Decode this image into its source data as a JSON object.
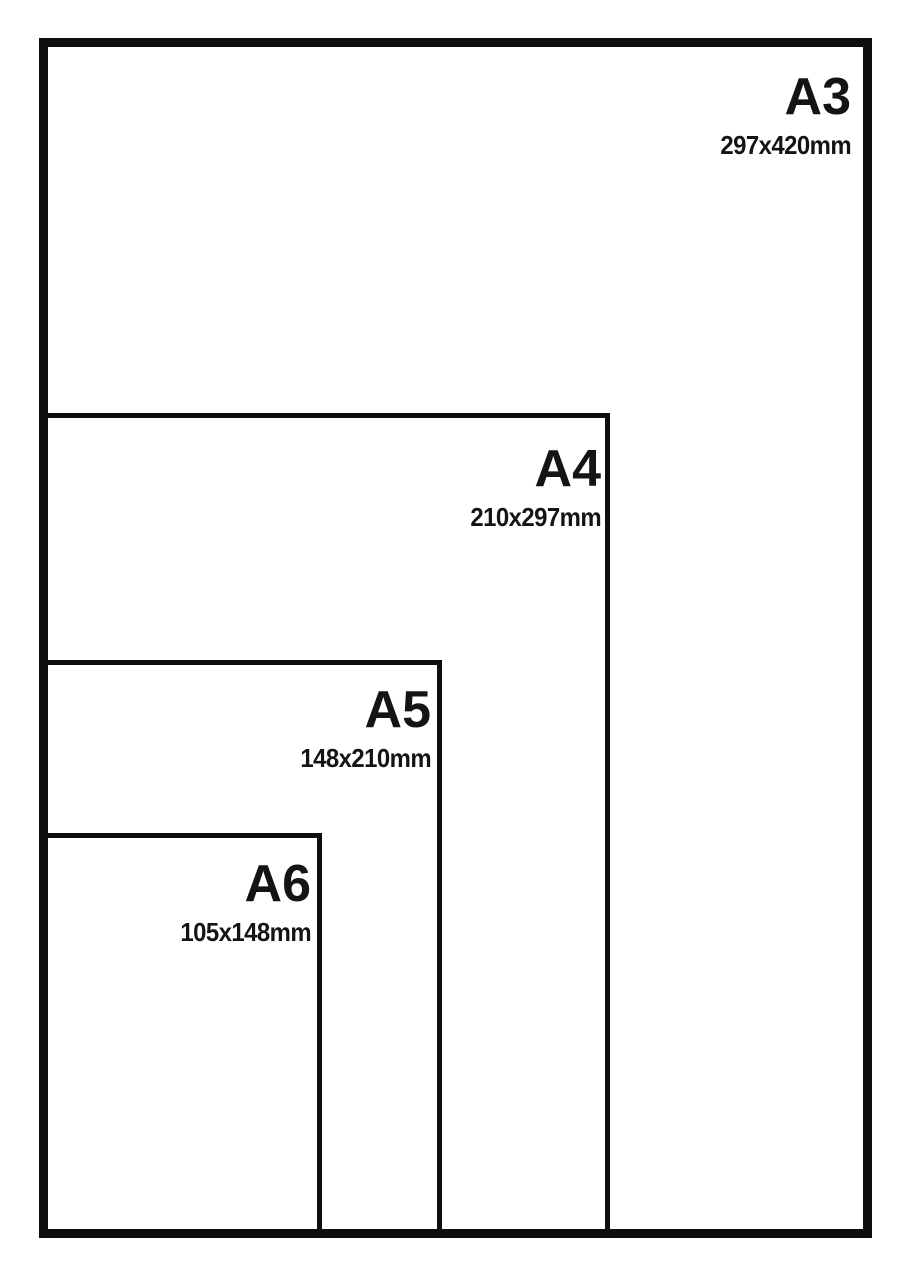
{
  "diagram": {
    "type": "paper-size-comparison",
    "sizes": [
      {
        "name": "A3",
        "dimensions": "297x420mm"
      },
      {
        "name": "A4",
        "dimensions": "210x297mm"
      },
      {
        "name": "A5",
        "dimensions": "148x210mm"
      },
      {
        "name": "A6",
        "dimensions": "105x148mm"
      }
    ]
  },
  "colors": {
    "line": "#0e0e0e",
    "text": "#141414",
    "background": "#ffffff"
  }
}
